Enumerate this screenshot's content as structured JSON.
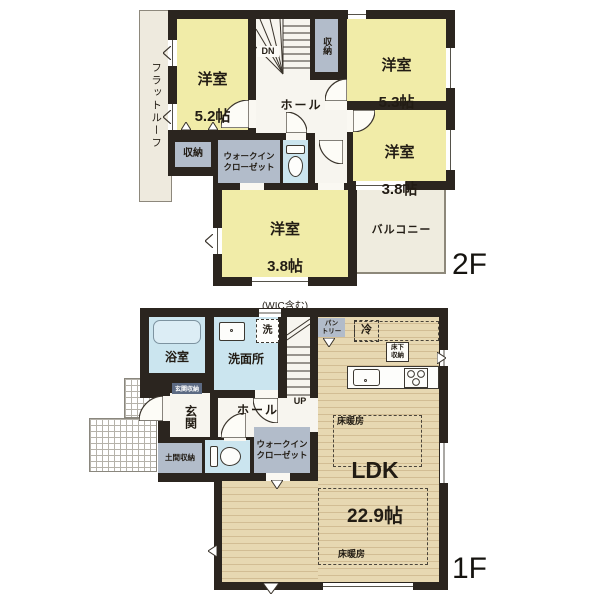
{
  "colors": {
    "wall": "#2b251f",
    "room_yellow": "#f1eca8",
    "water_blue": "#cbe5ef",
    "closet_gray": "#b2bcca",
    "wood_floor": "#e7d8b2",
    "hall_white": "#f7f5ef",
    "roof_beige": "#eeeade",
    "label_dark": "#221c14"
  },
  "floor2": {
    "floor_label": "2F",
    "flat_roof": "フラットルーフ",
    "stairs_dn": "DN",
    "closet_top": "収納",
    "room_5_2": {
      "name": "洋室",
      "size": "5.2帖"
    },
    "room_5_3": {
      "name": "洋室",
      "size": "5.3帖"
    },
    "hall": "ホール",
    "room_3_8_right": {
      "name": "洋室",
      "size": "3.8帖"
    },
    "closet_left": "収納",
    "walk_in_closet": "ウォークイン\nクローゼット",
    "room_3_8_center": {
      "name": "洋室",
      "size": "3.8帖",
      "note": "(WIC含む)"
    },
    "balcony": "バルコニー"
  },
  "floor1": {
    "floor_label": "1F",
    "bathroom": "浴室",
    "washroom": "洗面所",
    "laundry": "洗",
    "stairs_up": "UP",
    "pantry": "パン\nトリー",
    "refrigerator": "冷",
    "underfloor_storage": "床下\n収納",
    "entrance_storage": "玄関収納",
    "entrance": "玄関",
    "hall": "ホール",
    "doma_storage": "土間収納",
    "walk_in_closet": "ウォークイン\nクローゼット",
    "ldk": {
      "name": "LDK",
      "size": "22.9帖"
    },
    "floor_heating_upper": "床暖房",
    "floor_heating_lower": "床暖房"
  }
}
